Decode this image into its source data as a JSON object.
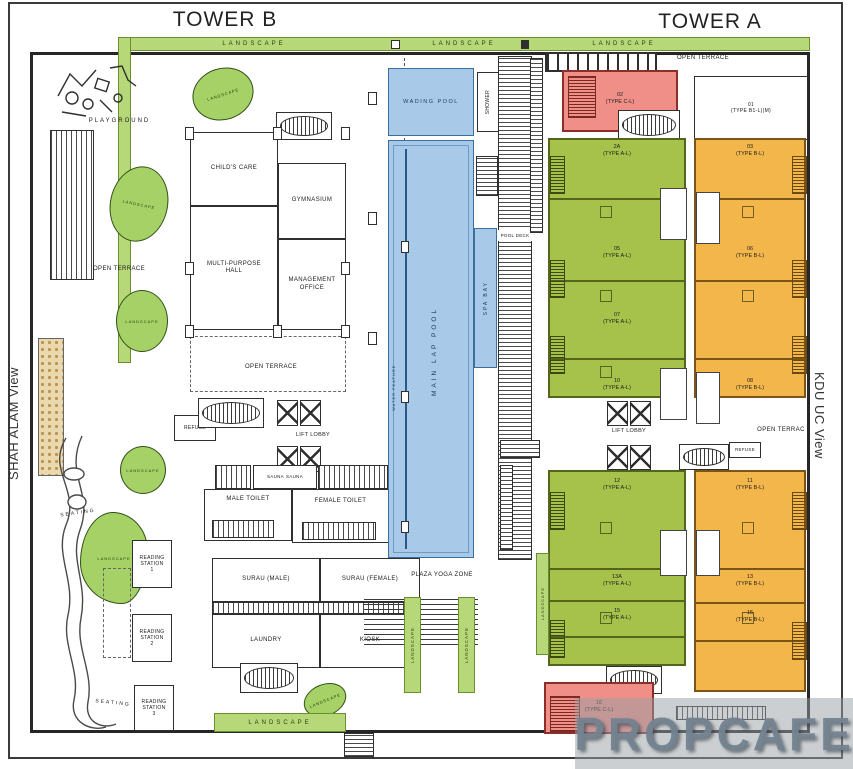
{
  "titles": {
    "tower_b": "TOWER B",
    "tower_a": "TOWER A",
    "left_view": "SHAH ALAM View",
    "right_view": "KDU UC View"
  },
  "labels": {
    "landscape": "LANDSCAPE",
    "playground": "PLAYGROUND",
    "childs_care": "CHILD'S CARE",
    "gymnasium": "GYMNASIUM",
    "multi_purpose_hall": "MULTI-PURPOSE HALL",
    "management_office": "MANAGEMENT OFFICE",
    "open_terrace": "OPEN TERRACE",
    "open_terrace_clipped": "OPEN TERRAC",
    "wading_pool": "WADING POOL",
    "shower": "SHOWER",
    "main_lap_pool": "MAIN LAP POOL",
    "water_feature": "WATER FEATURE",
    "spa_bay": "SPA BAY",
    "pool_deck": "POOL DECK",
    "lift_lobby": "LIFT LOBBY",
    "refuse": "REFUSE",
    "sauna": "SAUNA",
    "male_toilet": "MALE TOILET",
    "female_toilet": "FEMALE TOILET",
    "surau_male": "SURAU (MALE)",
    "surau_female": "SURAU (FEMALE)",
    "laundry": "LAUNDRY",
    "kiosk": "KIOSK",
    "plaza_yoga_zone": "PLAZA YOGA ZONE",
    "reading_station": "READING STATION",
    "seating": "SEATING"
  },
  "reading_stations": [
    "1",
    "2",
    "3"
  ],
  "units": {
    "unit01": {
      "no": "01",
      "type": "(TYPE B1-L)(M)"
    },
    "unit02": {
      "no": "02",
      "type": "(TYPE C-L)"
    },
    "unit16": {
      "no": "16",
      "type": "(TYPE C-L)"
    },
    "green_upper": [
      {
        "no": "2A",
        "type": "(TYPE A-L)"
      },
      {
        "no": "05",
        "type": "(TYPE A-L)"
      },
      {
        "no": "07",
        "type": "(TYPE A-L)"
      },
      {
        "no": "10",
        "type": "(TYPE A-L)"
      }
    ],
    "orange_upper": [
      {
        "no": "03",
        "type": "(TYPE B-L)"
      },
      {
        "no": "06",
        "type": "(TYPE B-L)"
      },
      {
        "no": "08",
        "type": "(TYPE B-L)"
      }
    ],
    "green_lower": [
      {
        "no": "12",
        "type": "(TYPE A-L)"
      },
      {
        "no": "13A",
        "type": "(TYPE A-L)"
      },
      {
        "no": "15",
        "type": "(TYPE A-L)"
      }
    ],
    "orange_lower": [
      {
        "no": "11",
        "type": "(TYPE B-L)"
      },
      {
        "no": "13",
        "type": "(TYPE B-L)"
      },
      {
        "no": "15",
        "type": "(TYPE B-L)"
      }
    ]
  },
  "watermark": "PROPCAFE",
  "colors": {
    "landscape_green": "#b7d878",
    "unit_green": "#a6c24a",
    "unit_orange": "#f3b64b",
    "unit_red": "#ef8f88",
    "pool_blue": "#a9c9e8",
    "wall": "#2f2f2f",
    "watermark_gray": "#748390"
  }
}
